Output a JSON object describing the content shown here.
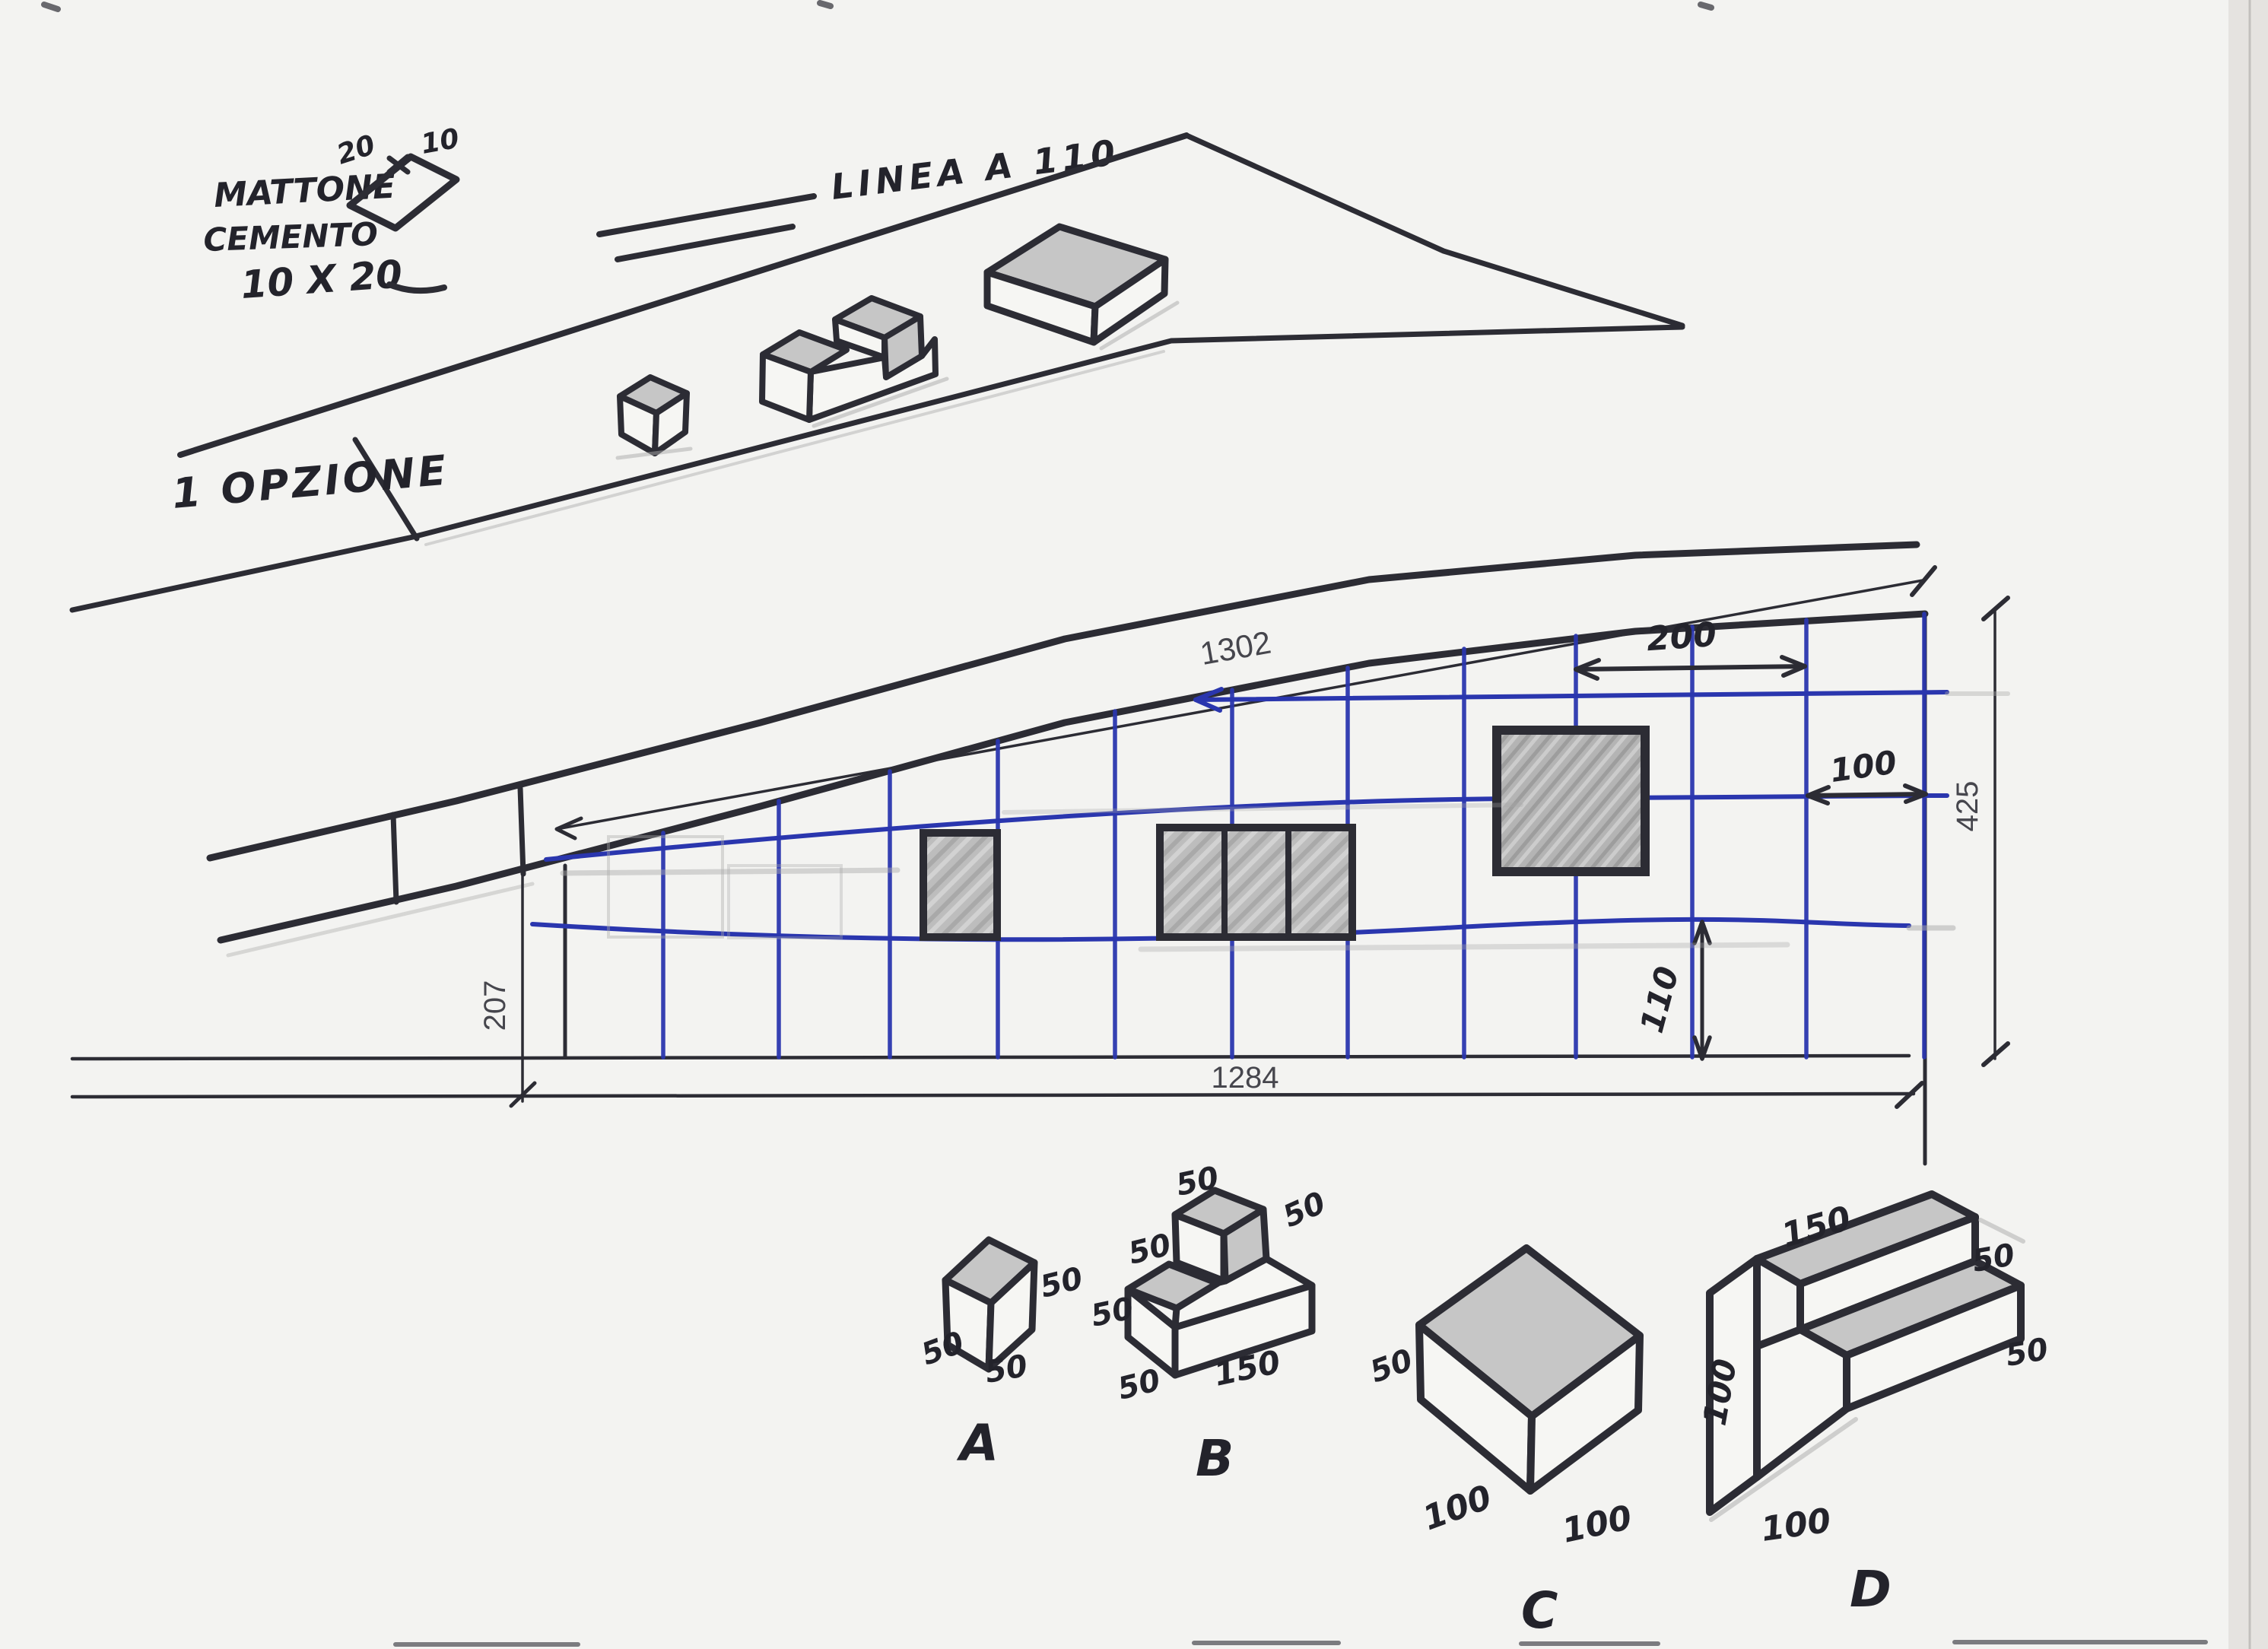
{
  "annotations": {
    "material": {
      "line1": "MATTONE",
      "line2": "CEMENTO",
      "size": "10 X 20"
    },
    "brick": {
      "width": "20",
      "height": "10"
    },
    "linea": "LINEA A 110",
    "option": "1 OPZIONE"
  },
  "plan": {
    "top_length": "1302",
    "bottom_length": "1284",
    "right_height": "425",
    "left_height": "207",
    "span_200": "200",
    "span_100": "100",
    "span_110": "110"
  },
  "blocks": {
    "a": {
      "label": "A",
      "dim_right": "50",
      "dim_left": "50",
      "dim_bottom": "50"
    },
    "b": {
      "label": "B",
      "dim_top": "50",
      "dim_top_right": "50",
      "dim_left": "50",
      "dim_left_lower": "50",
      "dim_bottom_left": "50",
      "dim_length": "150"
    },
    "c": {
      "label": "C",
      "dim_left": "50",
      "dim_bottom_left": "100",
      "dim_bottom_right": "100"
    },
    "d": {
      "label": "D",
      "dim_top": "150",
      "dim_top_right": "50",
      "dim_left": "100",
      "dim_right": "50",
      "dim_bottom": "100"
    }
  },
  "colors": {
    "grid_blue": "#2a36ae",
    "ink": "#2c2c34",
    "pencil": "#aaaaaa",
    "paper": "#f3f3f1",
    "hatch_gray": "#bdbdbd"
  }
}
